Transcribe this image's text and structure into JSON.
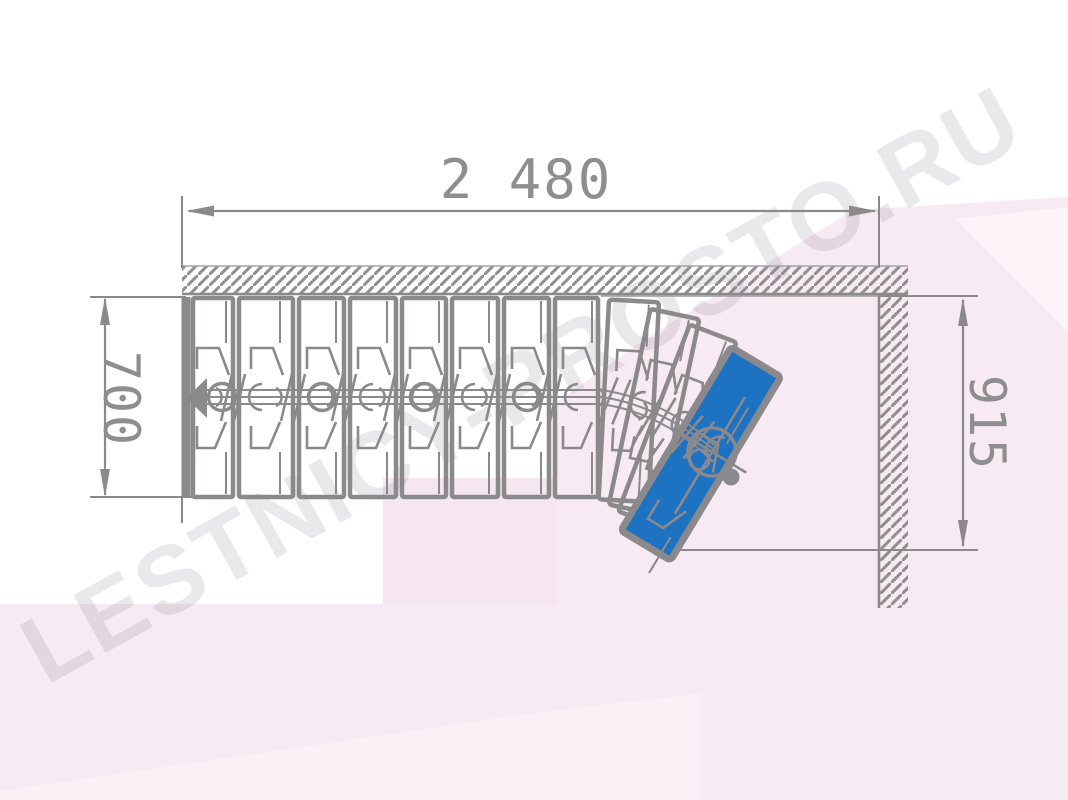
{
  "drawing": {
    "kind": "staircase-plan-top-view",
    "watermark": "LESTNICY-PROSTO.RU",
    "dimensions": {
      "total_run": "2 480",
      "flight_width": "700",
      "exit_opening": "915"
    },
    "stairs": {
      "straight_treads": 8,
      "winder_treads": 4,
      "highlighted_tread": "top winder tread",
      "walk_direction": "left (descent)"
    },
    "colors": {
      "line_gray": "#8b898c",
      "highlight_blue": "#1e72c2",
      "background_pink": "#f7eaf2",
      "watermark_gray": "#6d6672"
    }
  }
}
